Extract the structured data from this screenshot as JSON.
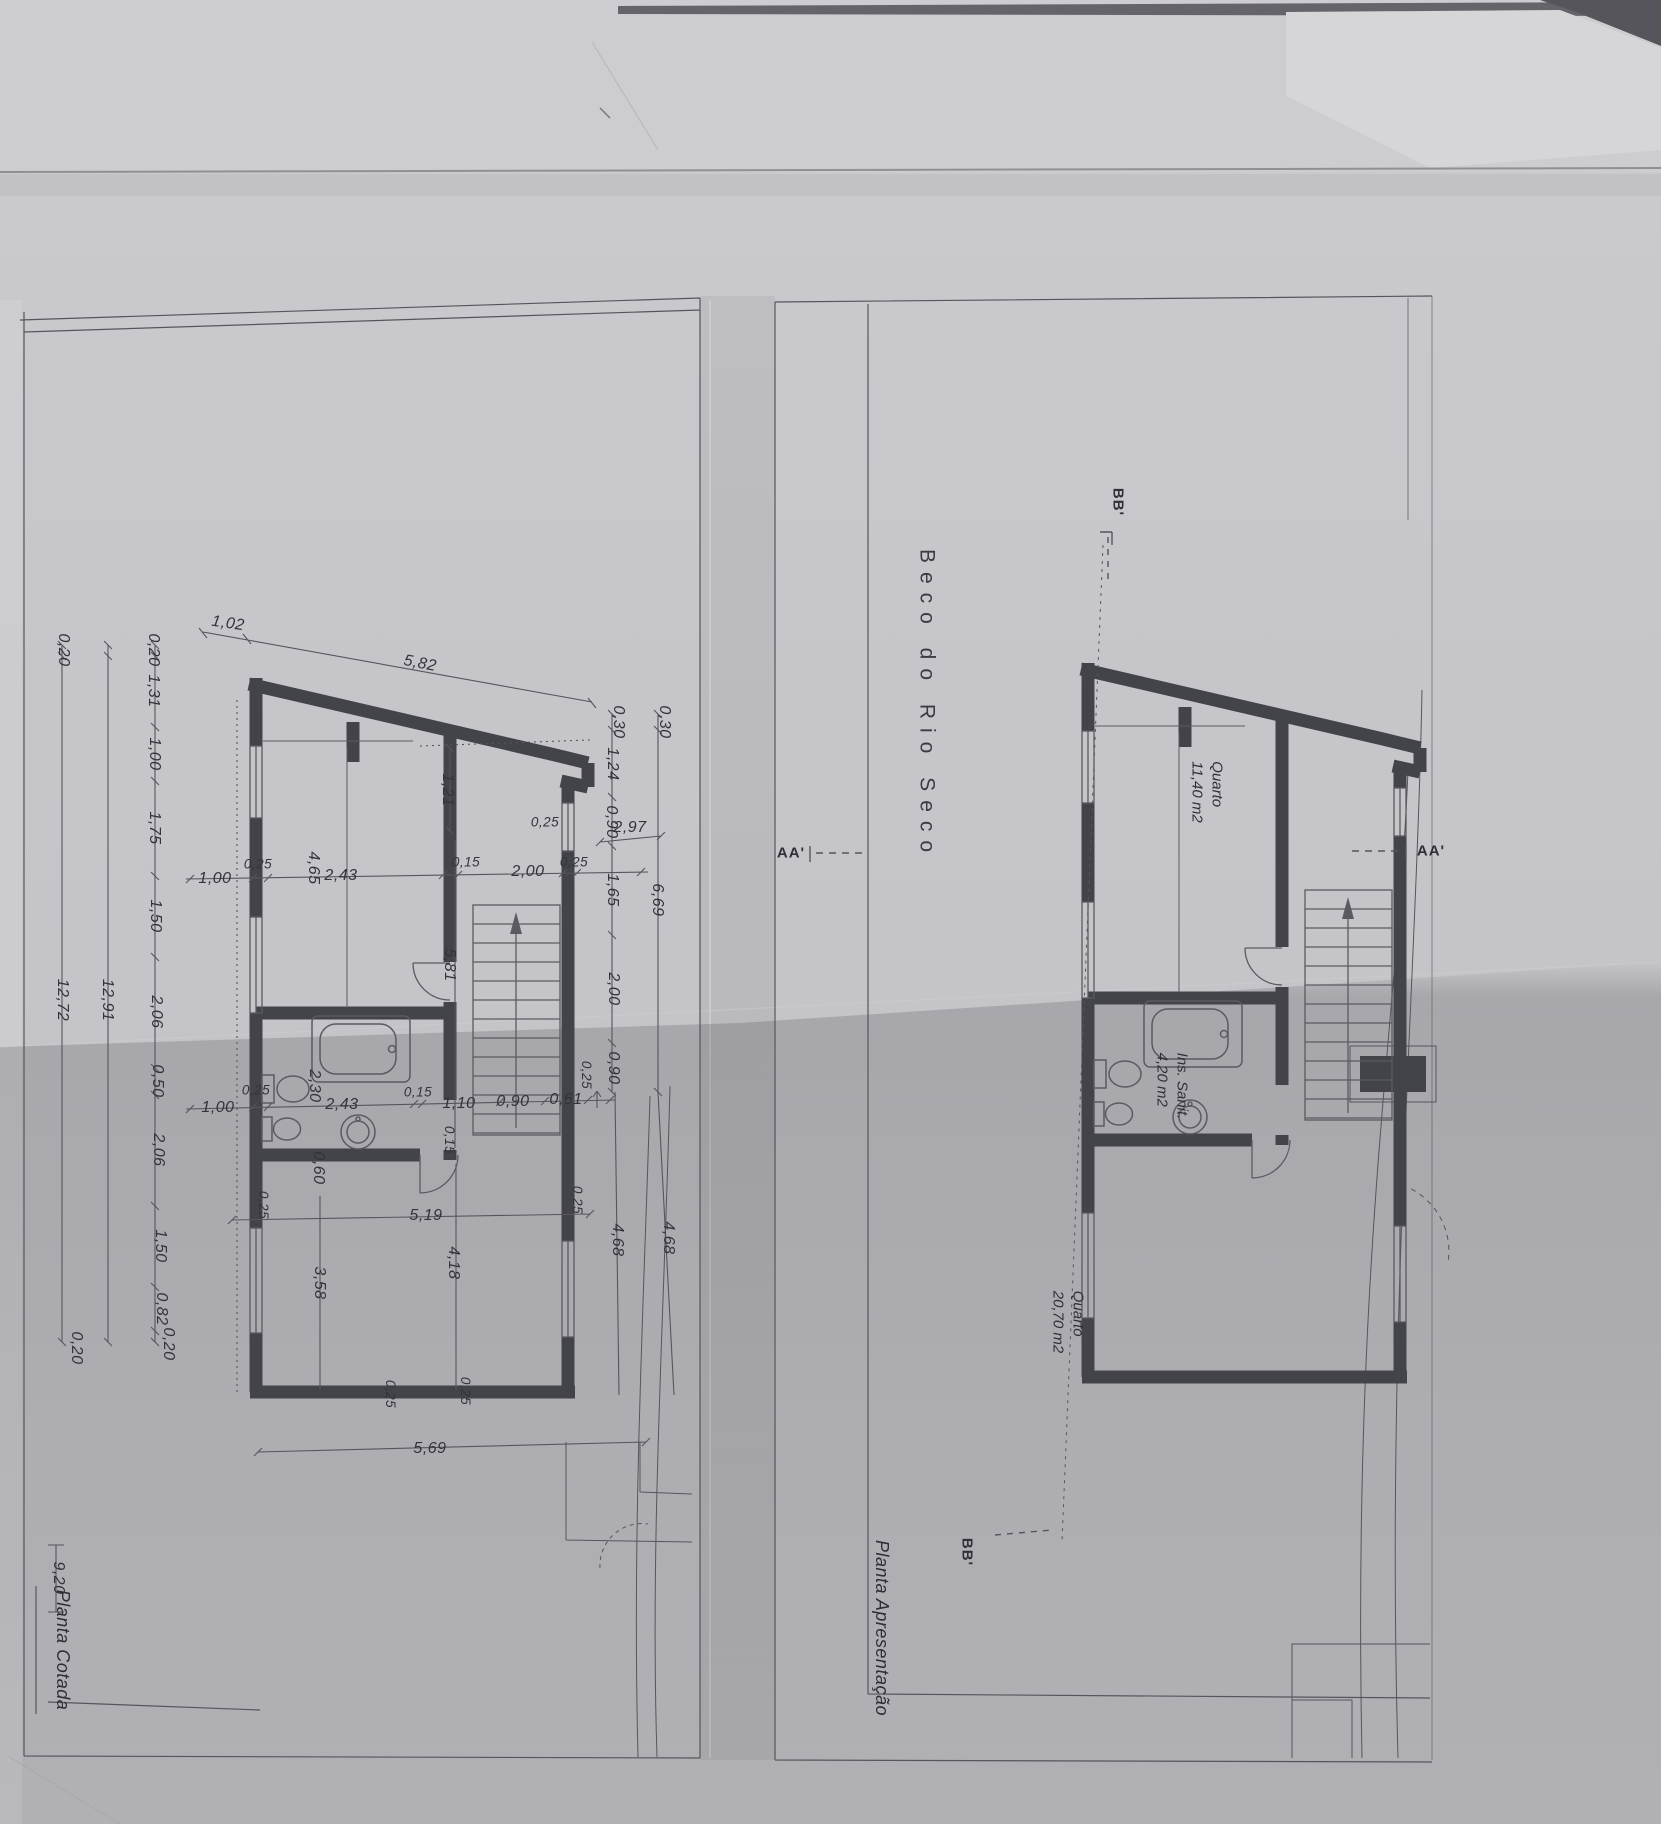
{
  "street_label": "Beco do Rio Seco",
  "sections": {
    "aa": "AA'",
    "bb": "BB'"
  },
  "left_plan": {
    "title": "Planta Cotada",
    "top_dims": {
      "d1": "1,02",
      "d2": "5,82"
    },
    "chain_a": [
      "1,00",
      "0,25",
      "2,43",
      "0,15",
      "2,00",
      "0,25",
      "2,97"
    ],
    "chain_b": [
      "1,00",
      "0,25",
      "2,43",
      "0,15",
      "1,10",
      "0,90",
      "0,61",
      "0,25"
    ],
    "room_dims": [
      "4,65",
      "1,21",
      "5,81",
      "2,30",
      "0,60",
      "0,15",
      "3,58",
      "4,18"
    ],
    "wall_dims": [
      "0,25",
      "0,25",
      "0,25",
      "0,25",
      "0,25"
    ],
    "chain_left_inner": [
      "0,20",
      "1,31",
      "1,00",
      "1,75",
      "1,50",
      "2,06",
      "0,50",
      "2,06",
      "1,50",
      "0,82",
      "0,20"
    ],
    "chain_left_total": "12,91",
    "chain_left_outer": [
      "0,20",
      "12,72",
      "0,20"
    ],
    "site_dim": "9,20",
    "chain_right_inner": [
      "0,30",
      "1,24",
      "0,90",
      "1,65",
      "2,00",
      "0,90"
    ],
    "chain_right_outer": [
      "0,30",
      "6,69"
    ],
    "chain_right_low": [
      "4,68",
      "4,68"
    ],
    "bottom_dims": [
      "5,19",
      "5,69"
    ]
  },
  "right_plan": {
    "title": "Planta Apresentação",
    "rooms": [
      {
        "name": "Quarto",
        "area": "11,40 m2"
      },
      {
        "name": "Ins. Sanit.",
        "area": "4,20 m2"
      },
      {
        "name": "Quarto",
        "area": "20,70 m2"
      }
    ]
  }
}
